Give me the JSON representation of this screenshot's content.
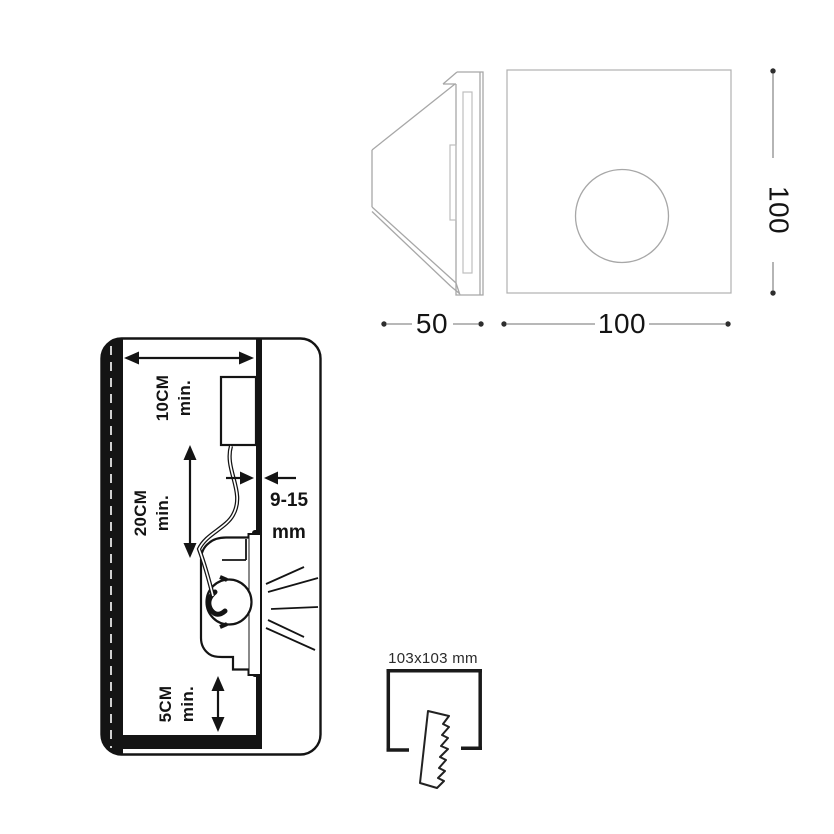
{
  "dimensions": {
    "side_width": "50",
    "front_width": "100",
    "front_height": "100"
  },
  "installation": {
    "top_clearance": {
      "value": "10CM",
      "qualifier": "min."
    },
    "side_clearance": {
      "value": "20CM",
      "qualifier": "min."
    },
    "bottom_clearance": {
      "value": "5CM",
      "qualifier": "min."
    },
    "panel_thickness": {
      "value": "9-15",
      "unit": "mm"
    }
  },
  "cutout": {
    "label": "103x103 mm"
  },
  "colors": {
    "ink": "#141414",
    "view_stroke": "#a7a7a7",
    "dim_stroke": "#8d8d8d",
    "background": "#ffffff"
  }
}
